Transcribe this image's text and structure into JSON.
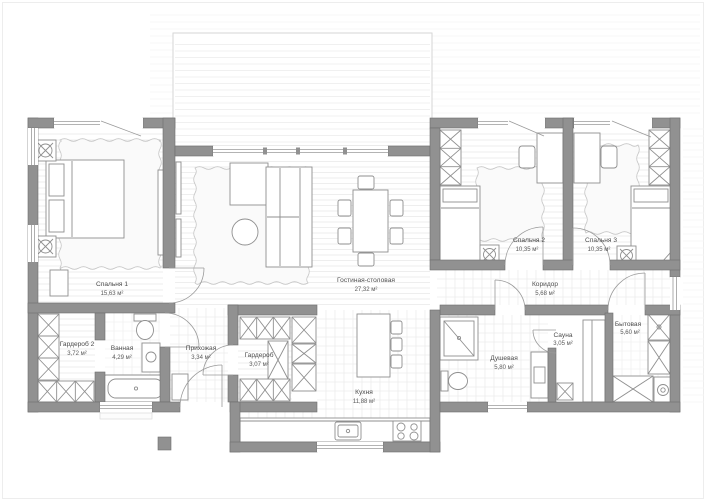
{
  "plan": {
    "rooms": [
      {
        "name": "Спальня 1",
        "area": "15,63 м²"
      },
      {
        "name": "Гостиная-столовая",
        "area": "27,32 м²"
      },
      {
        "name": "Спальня 2",
        "area": "10,35 м²"
      },
      {
        "name": "Спальня 3",
        "area": "10,35 м²"
      },
      {
        "name": "Коридор",
        "area": "5,68 м²"
      },
      {
        "name": "Гардероб 2",
        "area": "3,72 м²"
      },
      {
        "name": "Ванная",
        "area": "4,29 м²"
      },
      {
        "name": "Прихожая",
        "area": "3,34 м²"
      },
      {
        "name": "Гардероб",
        "area": "3,07 м²"
      },
      {
        "name": "Кухня",
        "area": "11,88 м²"
      },
      {
        "name": "Душевая",
        "area": "5,80 м²"
      },
      {
        "name": "Сауна",
        "area": "3,05 м²"
      },
      {
        "name": "Бытовая",
        "area": "5,60 м²"
      }
    ],
    "colors": {
      "wall": "#919191",
      "wall_edge": "#6e6e6e",
      "furniture_line": "#8f8f8f",
      "floor_line": "#e9e9e9",
      "tile_line": "#ececec",
      "terrace_line": "#ebebeb",
      "terrace_border": "#d6d6d6",
      "label_text": "#4d4d4d",
      "rug_edge": "#c6c6c6",
      "background": "#ffffff"
    }
  }
}
